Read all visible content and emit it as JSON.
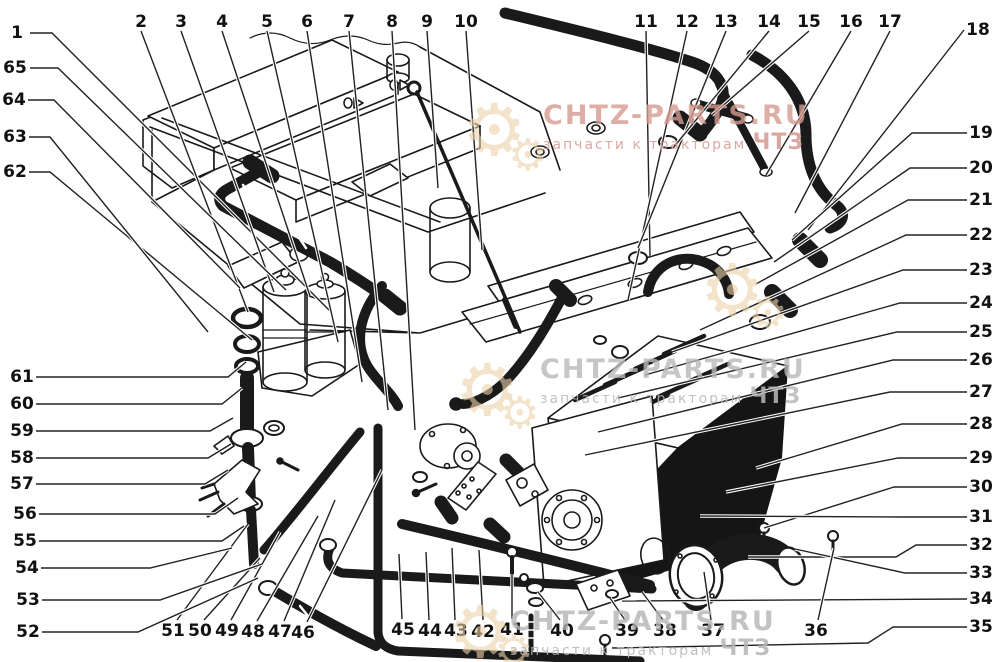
{
  "figure": {
    "type": "exploded-parts-diagram",
    "background_color": "#ffffff",
    "line_color": "#1a1a1a",
    "leader_color": "#222222",
    "callout_font_size": 17
  },
  "watermarks": [
    {
      "text": "CHTZ-PARTS.RU",
      "subtext": "запчасти к тракторам",
      "suffix": "ЧТЗ",
      "color": "#d49a90",
      "gear_glyph": "⚙"
    },
    {
      "text": "CHTZ-PARTS.RU",
      "subtext": "запчасти к тракторам",
      "suffix": "ЧТЗ",
      "color": "#b9b9b9",
      "gear_glyph": "⚙"
    },
    {
      "text": "CHTZ-PARTS.RU",
      "subtext": "запчасти к тракторам",
      "suffix": "ЧТЗ",
      "color": "#b5b5b5",
      "gear_glyph": "⚙"
    },
    {
      "gear_glyph": "⚙"
    }
  ],
  "callouts": [
    {
      "n": "1",
      "x": 17,
      "y": 33,
      "pts": [
        [
          30,
          33
        ],
        [
          52,
          33
        ],
        [
          330,
          311
        ]
      ]
    },
    {
      "n": "2",
      "x": 141,
      "y": 22,
      "pts": [
        [
          141,
          31
        ],
        [
          248,
          312
        ]
      ]
    },
    {
      "n": "3",
      "x": 181,
      "y": 22,
      "pts": [
        [
          181,
          31
        ],
        [
          274,
          292
        ]
      ]
    },
    {
      "n": "4",
      "x": 222,
      "y": 22,
      "pts": [
        [
          222,
          31
        ],
        [
          310,
          296
        ]
      ]
    },
    {
      "n": "5",
      "x": 267,
      "y": 22,
      "pts": [
        [
          267,
          31
        ],
        [
          338,
          342
        ]
      ]
    },
    {
      "n": "6",
      "x": 307,
      "y": 22,
      "pts": [
        [
          307,
          31
        ],
        [
          362,
          382
        ]
      ]
    },
    {
      "n": "7",
      "x": 349,
      "y": 22,
      "pts": [
        [
          349,
          31
        ],
        [
          388,
          410
        ]
      ]
    },
    {
      "n": "8",
      "x": 392,
      "y": 22,
      "pts": [
        [
          392,
          31
        ],
        [
          415,
          430
        ]
      ]
    },
    {
      "n": "9",
      "x": 427,
      "y": 22,
      "pts": [
        [
          427,
          31
        ],
        [
          438,
          188
        ]
      ]
    },
    {
      "n": "10",
      "x": 466,
      "y": 22,
      "pts": [
        [
          466,
          31
        ],
        [
          482,
          250
        ]
      ]
    },
    {
      "n": "11",
      "x": 646,
      "y": 22,
      "pts": [
        [
          646,
          31
        ],
        [
          650,
          256
        ]
      ]
    },
    {
      "n": "12",
      "x": 687,
      "y": 22,
      "pts": [
        [
          687,
          31
        ],
        [
          628,
          300
        ]
      ]
    },
    {
      "n": "13",
      "x": 726,
      "y": 22,
      "pts": [
        [
          726,
          31
        ],
        [
          638,
          248
        ]
      ]
    },
    {
      "n": "14",
      "x": 769,
      "y": 22,
      "pts": [
        [
          769,
          31
        ],
        [
          673,
          148
        ]
      ]
    },
    {
      "n": "15",
      "x": 809,
      "y": 22,
      "pts": [
        [
          809,
          31
        ],
        [
          712,
          115
        ]
      ]
    },
    {
      "n": "16",
      "x": 851,
      "y": 22,
      "pts": [
        [
          851,
          31
        ],
        [
          766,
          175
        ]
      ]
    },
    {
      "n": "17",
      "x": 890,
      "y": 22,
      "pts": [
        [
          890,
          31
        ],
        [
          795,
          213
        ]
      ]
    },
    {
      "n": "18",
      "x": 978,
      "y": 30,
      "pts": [
        [
          964,
          30
        ],
        [
          808,
          230
        ]
      ]
    },
    {
      "n": "19",
      "x": 981,
      "y": 133,
      "pts": [
        [
          967,
          133
        ],
        [
          912,
          133
        ],
        [
          792,
          240
        ]
      ]
    },
    {
      "n": "20",
      "x": 981,
      "y": 168,
      "pts": [
        [
          967,
          168
        ],
        [
          910,
          168
        ],
        [
          774,
          262
        ]
      ]
    },
    {
      "n": "21",
      "x": 981,
      "y": 200,
      "pts": [
        [
          967,
          200
        ],
        [
          908,
          200
        ],
        [
          756,
          284
        ]
      ]
    },
    {
      "n": "22",
      "x": 981,
      "y": 235,
      "pts": [
        [
          967,
          235
        ],
        [
          906,
          235
        ],
        [
          700,
          330
        ]
      ]
    },
    {
      "n": "23",
      "x": 981,
      "y": 270,
      "pts": [
        [
          967,
          270
        ],
        [
          903,
          270
        ],
        [
          672,
          352
        ]
      ]
    },
    {
      "n": "24",
      "x": 981,
      "y": 303,
      "pts": [
        [
          967,
          303
        ],
        [
          900,
          303
        ],
        [
          645,
          375
        ]
      ]
    },
    {
      "n": "25",
      "x": 981,
      "y": 332,
      "pts": [
        [
          967,
          332
        ],
        [
          897,
          332
        ],
        [
          618,
          398
        ]
      ]
    },
    {
      "n": "26",
      "x": 981,
      "y": 360,
      "pts": [
        [
          967,
          360
        ],
        [
          893,
          360
        ],
        [
          598,
          432
        ]
      ]
    },
    {
      "n": "27",
      "x": 981,
      "y": 392,
      "pts": [
        [
          967,
          392
        ],
        [
          890,
          392
        ],
        [
          585,
          455
        ]
      ]
    },
    {
      "n": "28",
      "x": 981,
      "y": 424,
      "pts": [
        [
          967,
          424
        ],
        [
          902,
          424
        ],
        [
          756,
          468
        ]
      ]
    },
    {
      "n": "29",
      "x": 981,
      "y": 458,
      "pts": [
        [
          967,
          458
        ],
        [
          898,
          458
        ],
        [
          726,
          492
        ]
      ]
    },
    {
      "n": "30",
      "x": 981,
      "y": 487,
      "pts": [
        [
          967,
          487
        ],
        [
          894,
          487
        ],
        [
          764,
          528
        ]
      ]
    },
    {
      "n": "31",
      "x": 981,
      "y": 517,
      "pts": [
        [
          967,
          517
        ],
        [
          902,
          517
        ],
        [
          700,
          516
        ]
      ]
    },
    {
      "n": "32",
      "x": 981,
      "y": 545,
      "pts": [
        [
          967,
          545
        ],
        [
          916,
          545
        ],
        [
          896,
          557
        ],
        [
          748,
          557
        ]
      ]
    },
    {
      "n": "33",
      "x": 981,
      "y": 573,
      "pts": [
        [
          967,
          573
        ],
        [
          905,
          573
        ],
        [
          795,
          549
        ]
      ]
    },
    {
      "n": "34",
      "x": 981,
      "y": 599,
      "pts": [
        [
          967,
          599
        ],
        [
          622,
          601
        ]
      ]
    },
    {
      "n": "35",
      "x": 981,
      "y": 627,
      "pts": [
        [
          967,
          627
        ],
        [
          893,
          627
        ],
        [
          868,
          643
        ],
        [
          612,
          648
        ]
      ]
    },
    {
      "n": "36",
      "x": 816,
      "y": 631,
      "pts": [
        [
          818,
          620
        ],
        [
          834,
          548
        ]
      ]
    },
    {
      "n": "37",
      "x": 713,
      "y": 631,
      "pts": [
        [
          711,
          620
        ],
        [
          704,
          572
        ]
      ]
    },
    {
      "n": "38",
      "x": 665,
      "y": 631,
      "pts": [
        [
          663,
          620
        ],
        [
          642,
          592
        ]
      ]
    },
    {
      "n": "39",
      "x": 627,
      "y": 631,
      "pts": [
        [
          625,
          620
        ],
        [
          610,
          598
        ]
      ]
    },
    {
      "n": "40",
      "x": 562,
      "y": 631,
      "pts": [
        [
          560,
          620
        ],
        [
          538,
          592
        ]
      ]
    },
    {
      "n": "41",
      "x": 512,
      "y": 630,
      "pts": [
        [
          512,
          619
        ],
        [
          512,
          574
        ]
      ]
    },
    {
      "n": "42",
      "x": 483,
      "y": 632,
      "pts": [
        [
          483,
          620
        ],
        [
          479,
          550
        ]
      ]
    },
    {
      "n": "43",
      "x": 456,
      "y": 631,
      "pts": [
        [
          455,
          620
        ],
        [
          452,
          548
        ]
      ]
    },
    {
      "n": "44",
      "x": 430,
      "y": 631,
      "pts": [
        [
          429,
          620
        ],
        [
          426,
          552
        ]
      ]
    },
    {
      "n": "45",
      "x": 403,
      "y": 630,
      "pts": [
        [
          402,
          619
        ],
        [
          399,
          554
        ]
      ]
    },
    {
      "n": "46",
      "x": 303,
      "y": 633,
      "pts": [
        [
          307,
          622
        ],
        [
          382,
          470
        ]
      ]
    },
    {
      "n": "47",
      "x": 280,
      "y": 632,
      "pts": [
        [
          284,
          621
        ],
        [
          335,
          500
        ]
      ]
    },
    {
      "n": "48",
      "x": 253,
      "y": 632,
      "pts": [
        [
          257,
          621
        ],
        [
          318,
          516
        ]
      ]
    },
    {
      "n": "49",
      "x": 227,
      "y": 631,
      "pts": [
        [
          231,
          620
        ],
        [
          280,
          532
        ]
      ]
    },
    {
      "n": "50",
      "x": 200,
      "y": 631,
      "pts": [
        [
          204,
          620
        ],
        [
          260,
          558
        ]
      ]
    },
    {
      "n": "51",
      "x": 173,
      "y": 631,
      "pts": [
        [
          177,
          620
        ],
        [
          248,
          524
        ]
      ]
    },
    {
      "n": "52",
      "x": 28,
      "y": 632,
      "pts": [
        [
          42,
          632
        ],
        [
          138,
          632
        ],
        [
          258,
          578
        ]
      ]
    },
    {
      "n": "53",
      "x": 28,
      "y": 600,
      "pts": [
        [
          42,
          600
        ],
        [
          160,
          600
        ],
        [
          262,
          564
        ]
      ]
    },
    {
      "n": "54",
      "x": 27,
      "y": 568,
      "pts": [
        [
          41,
          568
        ],
        [
          150,
          568
        ],
        [
          232,
          548
        ]
      ]
    },
    {
      "n": "55",
      "x": 25,
      "y": 541,
      "pts": [
        [
          39,
          541
        ],
        [
          222,
          541
        ],
        [
          244,
          526
        ]
      ]
    },
    {
      "n": "56",
      "x": 25,
      "y": 514,
      "pts": [
        [
          39,
          514
        ],
        [
          215,
          514
        ],
        [
          238,
          498
        ]
      ]
    },
    {
      "n": "57",
      "x": 22,
      "y": 484,
      "pts": [
        [
          36,
          484
        ],
        [
          205,
          484
        ],
        [
          228,
          470
        ]
      ]
    },
    {
      "n": "58",
      "x": 22,
      "y": 458,
      "pts": [
        [
          36,
          458
        ],
        [
          208,
          458
        ],
        [
          231,
          444
        ]
      ]
    },
    {
      "n": "59",
      "x": 22,
      "y": 431,
      "pts": [
        [
          36,
          431
        ],
        [
          210,
          431
        ],
        [
          233,
          418
        ]
      ]
    },
    {
      "n": "60",
      "x": 22,
      "y": 404,
      "pts": [
        [
          36,
          404
        ],
        [
          222,
          404
        ],
        [
          242,
          388
        ]
      ]
    },
    {
      "n": "61",
      "x": 22,
      "y": 377,
      "pts": [
        [
          36,
          377
        ],
        [
          228,
          377
        ],
        [
          246,
          362
        ]
      ]
    },
    {
      "n": "62",
      "x": 15,
      "y": 172,
      "pts": [
        [
          29,
          172
        ],
        [
          50,
          172
        ],
        [
          252,
          340
        ]
      ]
    },
    {
      "n": "63",
      "x": 15,
      "y": 137,
      "pts": [
        [
          29,
          137
        ],
        [
          50,
          137
        ],
        [
          208,
          332
        ]
      ]
    },
    {
      "n": "64",
      "x": 14,
      "y": 100,
      "pts": [
        [
          28,
          100
        ],
        [
          54,
          100
        ],
        [
          240,
          288
        ]
      ]
    },
    {
      "n": "65",
      "x": 15,
      "y": 68,
      "pts": [
        [
          30,
          68
        ],
        [
          58,
          68
        ],
        [
          286,
          290
        ]
      ]
    }
  ]
}
